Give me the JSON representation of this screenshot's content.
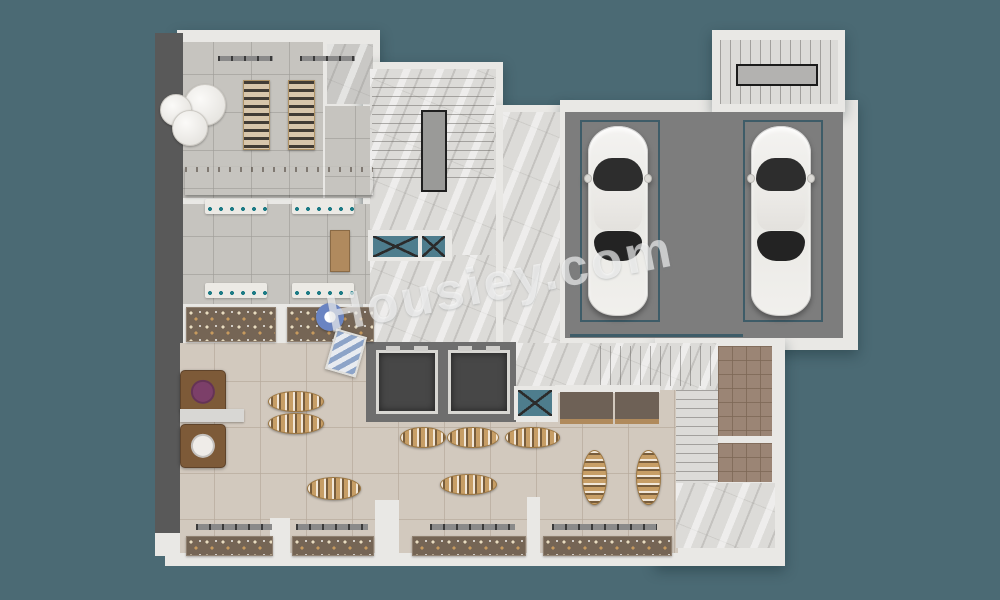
{
  "watermark": {
    "text": "Housiey.com",
    "color": "#ffffff",
    "opacity": 0.6,
    "rotation_deg": -11
  },
  "palette": {
    "background": "#4b6a74",
    "wall": "#e9e8e5",
    "outer_wall_dark": "#595959",
    "marble": "#dcdbd8",
    "tile_gray": "#c6c4bf",
    "tile_beige": "#d2c9be",
    "tile_brown": "#9b8575",
    "garage_floor": "#7d7d7d",
    "parking_outline": "#3e5c68",
    "wood_table": "#c79e66",
    "shaft_blue": "#4e7d8d",
    "elevator_cabin": "#474747",
    "car_body": "#f1f0ed"
  },
  "cars": [
    {
      "name": "car-1",
      "x": 588,
      "y": 126,
      "w": 60,
      "h": 190
    },
    {
      "name": "car-2",
      "x": 751,
      "y": 126,
      "w": 60,
      "h": 190
    }
  ],
  "parking_spaces": [
    {
      "name": "parking-space-1",
      "x": 580,
      "y": 120,
      "w": 76,
      "h": 198
    },
    {
      "name": "parking-space-2",
      "x": 743,
      "y": 120,
      "w": 76,
      "h": 198
    }
  ],
  "furniture": [
    {
      "type": "round-table",
      "name": "round-display-table-1",
      "x": 184,
      "y": 84,
      "w": 40,
      "h": 40
    },
    {
      "type": "round-table",
      "name": "round-display-table-2",
      "x": 160,
      "y": 94,
      "w": 30,
      "h": 30
    },
    {
      "type": "round-table",
      "name": "round-display-table-3",
      "x": 172,
      "y": 110,
      "w": 34,
      "h": 34
    },
    {
      "type": "shoe-rack",
      "name": "shoe-display-rack-1",
      "x": 243,
      "y": 80,
      "w": 25,
      "h": 68
    },
    {
      "type": "shoe-rack",
      "name": "shoe-display-rack-2",
      "x": 288,
      "y": 80,
      "w": 25,
      "h": 68
    },
    {
      "type": "rack-bar",
      "name": "hanging-rail-1",
      "x": 218,
      "y": 56,
      "w": 55,
      "h": 5
    },
    {
      "type": "rack-bar",
      "name": "hanging-rail-2",
      "x": 300,
      "y": 56,
      "w": 55,
      "h": 5
    },
    {
      "type": "counter-white",
      "name": "checkout-counter",
      "x": 185,
      "y": 167,
      "w": 188,
      "h": 28
    },
    {
      "type": "wall-shelf",
      "name": "wall-shelf-1",
      "x": 205,
      "y": 199,
      "w": 62,
      "h": 15
    },
    {
      "type": "wall-shelf",
      "name": "wall-shelf-2",
      "x": 292,
      "y": 199,
      "w": 62,
      "h": 15
    },
    {
      "type": "wall-shelf",
      "name": "wall-shelf-3",
      "x": 205,
      "y": 283,
      "w": 62,
      "h": 15
    },
    {
      "type": "wall-shelf",
      "name": "wall-shelf-4",
      "x": 292,
      "y": 283,
      "w": 62,
      "h": 15
    },
    {
      "type": "desk",
      "name": "storage-desk",
      "x": 330,
      "y": 230,
      "w": 18,
      "h": 40
    },
    {
      "type": "display-counter",
      "name": "display-case-1",
      "x": 186,
      "y": 307,
      "w": 88,
      "h": 33
    },
    {
      "type": "display-counter",
      "name": "display-case-2",
      "x": 287,
      "y": 307,
      "w": 85,
      "h": 33
    },
    {
      "type": "blue-flower",
      "name": "flower-display",
      "x": 316,
      "y": 303,
      "w": 28,
      "h": 28
    },
    {
      "type": "tilt-panel",
      "name": "leaning-artwork",
      "x": 330,
      "y": 332,
      "w": 28,
      "h": 38
    },
    {
      "type": "square-table",
      "name": "square-display-table-1",
      "x": 180,
      "y": 370,
      "w": 44,
      "h": 42,
      "center": "#7c3f69"
    },
    {
      "type": "gray-shelf",
      "name": "shelf-divider",
      "x": 180,
      "y": 409,
      "w": 64,
      "h": 13
    },
    {
      "type": "square-table",
      "name": "square-display-table-2",
      "x": 180,
      "y": 424,
      "w": 44,
      "h": 42,
      "center": "#efece8"
    },
    {
      "type": "oval-h",
      "name": "oval-display-table-1",
      "x": 268,
      "y": 391,
      "w": 54,
      "h": 19
    },
    {
      "type": "oval-h",
      "name": "oval-display-table-2",
      "x": 268,
      "y": 413,
      "w": 54,
      "h": 19
    },
    {
      "type": "oval-h",
      "name": "oval-display-table-3",
      "x": 400,
      "y": 427,
      "w": 44,
      "h": 19
    },
    {
      "type": "oval-h",
      "name": "oval-display-table-4",
      "x": 447,
      "y": 427,
      "w": 50,
      "h": 19
    },
    {
      "type": "oval-h",
      "name": "oval-display-table-5",
      "x": 505,
      "y": 427,
      "w": 53,
      "h": 19
    },
    {
      "type": "oval-h",
      "name": "oval-display-table-6",
      "x": 440,
      "y": 474,
      "w": 55,
      "h": 19
    },
    {
      "type": "oval-h",
      "name": "oval-display-table-7",
      "x": 307,
      "y": 477,
      "w": 52,
      "h": 21
    },
    {
      "type": "oval-v",
      "name": "oval-display-table-8",
      "x": 582,
      "y": 450,
      "w": 23,
      "h": 53
    },
    {
      "type": "oval-v",
      "name": "oval-display-table-9",
      "x": 636,
      "y": 450,
      "w": 23,
      "h": 53
    },
    {
      "type": "rack-bar",
      "name": "storefront-rail-1",
      "x": 196,
      "y": 524,
      "w": 76,
      "h": 6
    },
    {
      "type": "rack-bar",
      "name": "storefront-rail-2",
      "x": 296,
      "y": 524,
      "w": 72,
      "h": 6
    },
    {
      "type": "rack-bar",
      "name": "storefront-rail-3",
      "x": 430,
      "y": 524,
      "w": 85,
      "h": 6
    },
    {
      "type": "rack-bar",
      "name": "storefront-rail-4",
      "x": 552,
      "y": 524,
      "w": 105,
      "h": 6
    },
    {
      "type": "display-counter",
      "name": "storefront-display-1",
      "x": 186,
      "y": 536,
      "w": 85,
      "h": 18
    },
    {
      "type": "display-counter",
      "name": "storefront-display-2",
      "x": 292,
      "y": 536,
      "w": 80,
      "h": 18
    },
    {
      "type": "display-counter",
      "name": "storefront-display-3",
      "x": 412,
      "y": 536,
      "w": 112,
      "h": 18
    },
    {
      "type": "display-counter",
      "name": "storefront-display-4",
      "x": 543,
      "y": 536,
      "w": 127,
      "h": 18
    },
    {
      "type": "shaft-x",
      "name": "vent-shaft-1",
      "x": 373,
      "y": 236,
      "w": 45,
      "h": 21
    },
    {
      "type": "shaft-x",
      "name": "vent-shaft-2",
      "x": 422,
      "y": 236,
      "w": 23,
      "h": 21
    },
    {
      "type": "shaft-x",
      "name": "vent-shaft-3",
      "x": 518,
      "y": 390,
      "w": 34,
      "h": 26
    }
  ]
}
